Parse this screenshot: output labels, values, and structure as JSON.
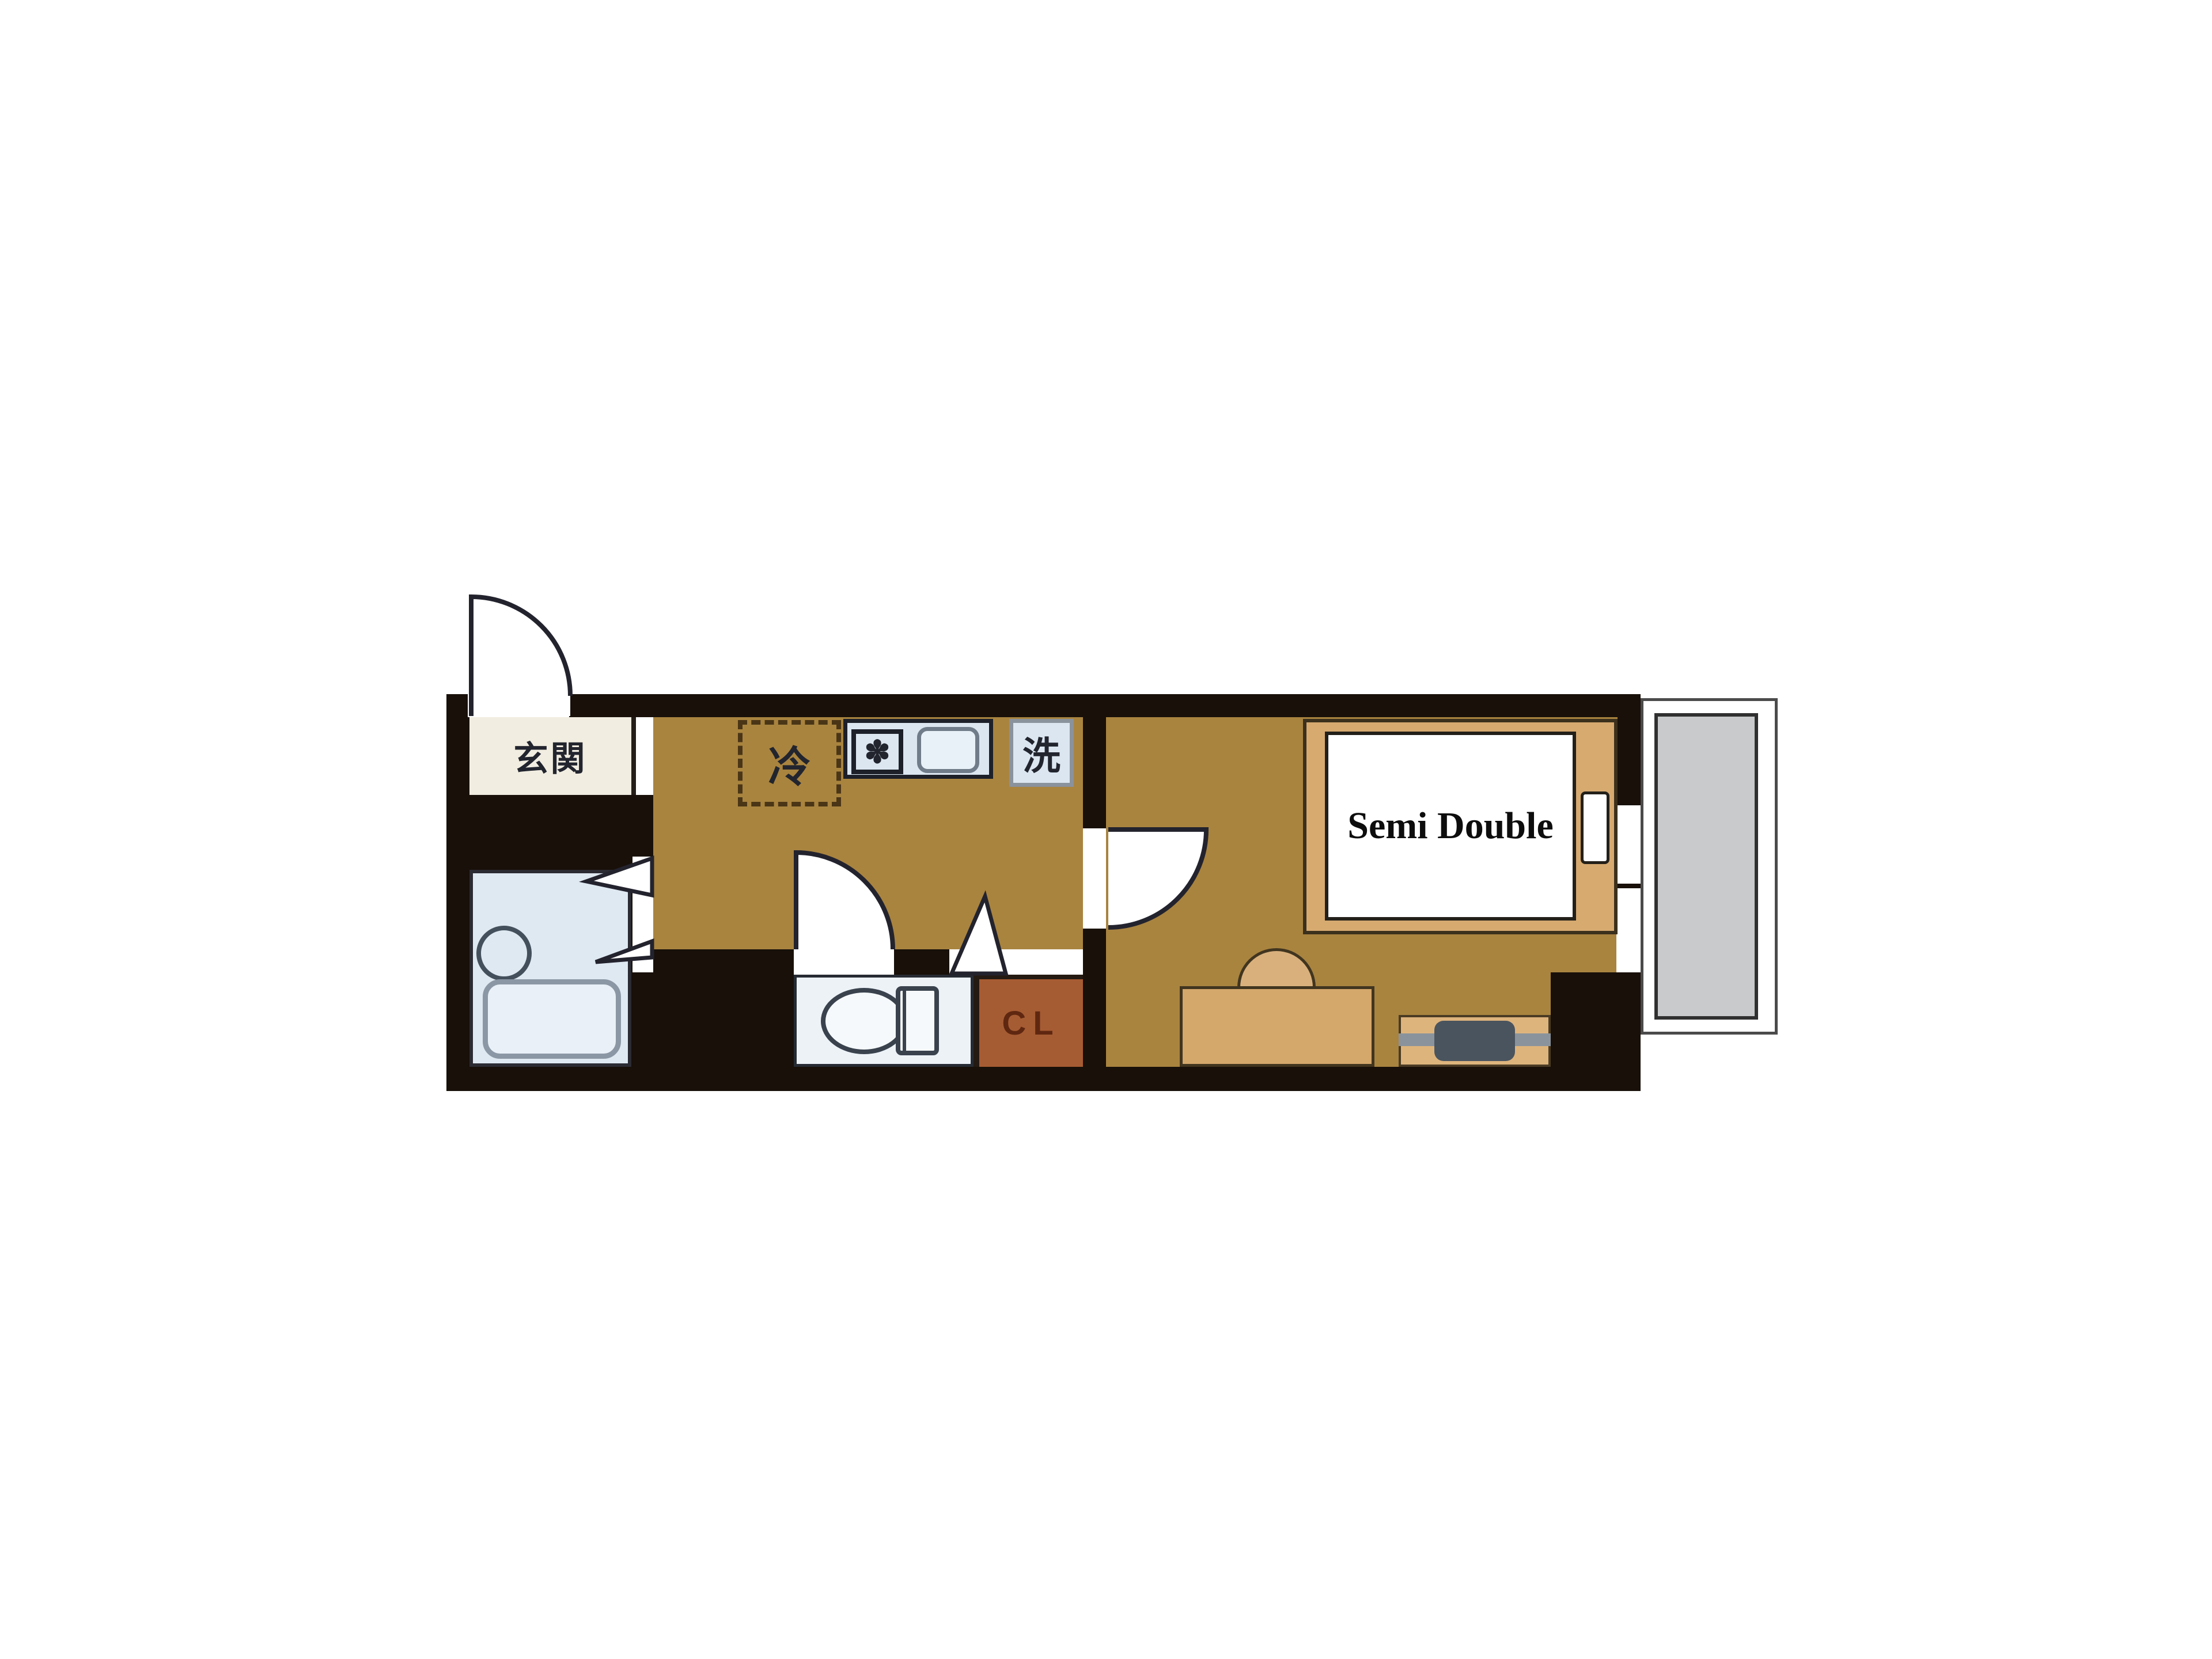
{
  "title": "apartment-floor-plan",
  "labels": {
    "entrance": "玄関",
    "refrigerator": "冷",
    "washer": "洗",
    "stove_symbol": "✽",
    "closet": "CL",
    "bed": "Semi Double"
  },
  "colors": {
    "floor": "#a9843f",
    "wall": "#181009",
    "outline": "#23232e",
    "genkan": "#f1ede1",
    "bath": "#dfe9f2",
    "fixture_fill": "#e9f0f7",
    "fixture_line": "#8b97a4",
    "counter": "#dbe6f1",
    "counter_line": "#1d2029",
    "toilet_room": "#edf2f7",
    "closet": "#a65c33",
    "closet_text": "#5f2710",
    "bed_frame": "#d7aa70",
    "mattress": "#ffffff",
    "furniture": "#d4a76b",
    "tv": "#4a545e",
    "tv_line": "#8a939c",
    "balcony": "#c9cacb",
    "balcony_line": "#4b4b4b",
    "label_dark": "#22252e"
  }
}
